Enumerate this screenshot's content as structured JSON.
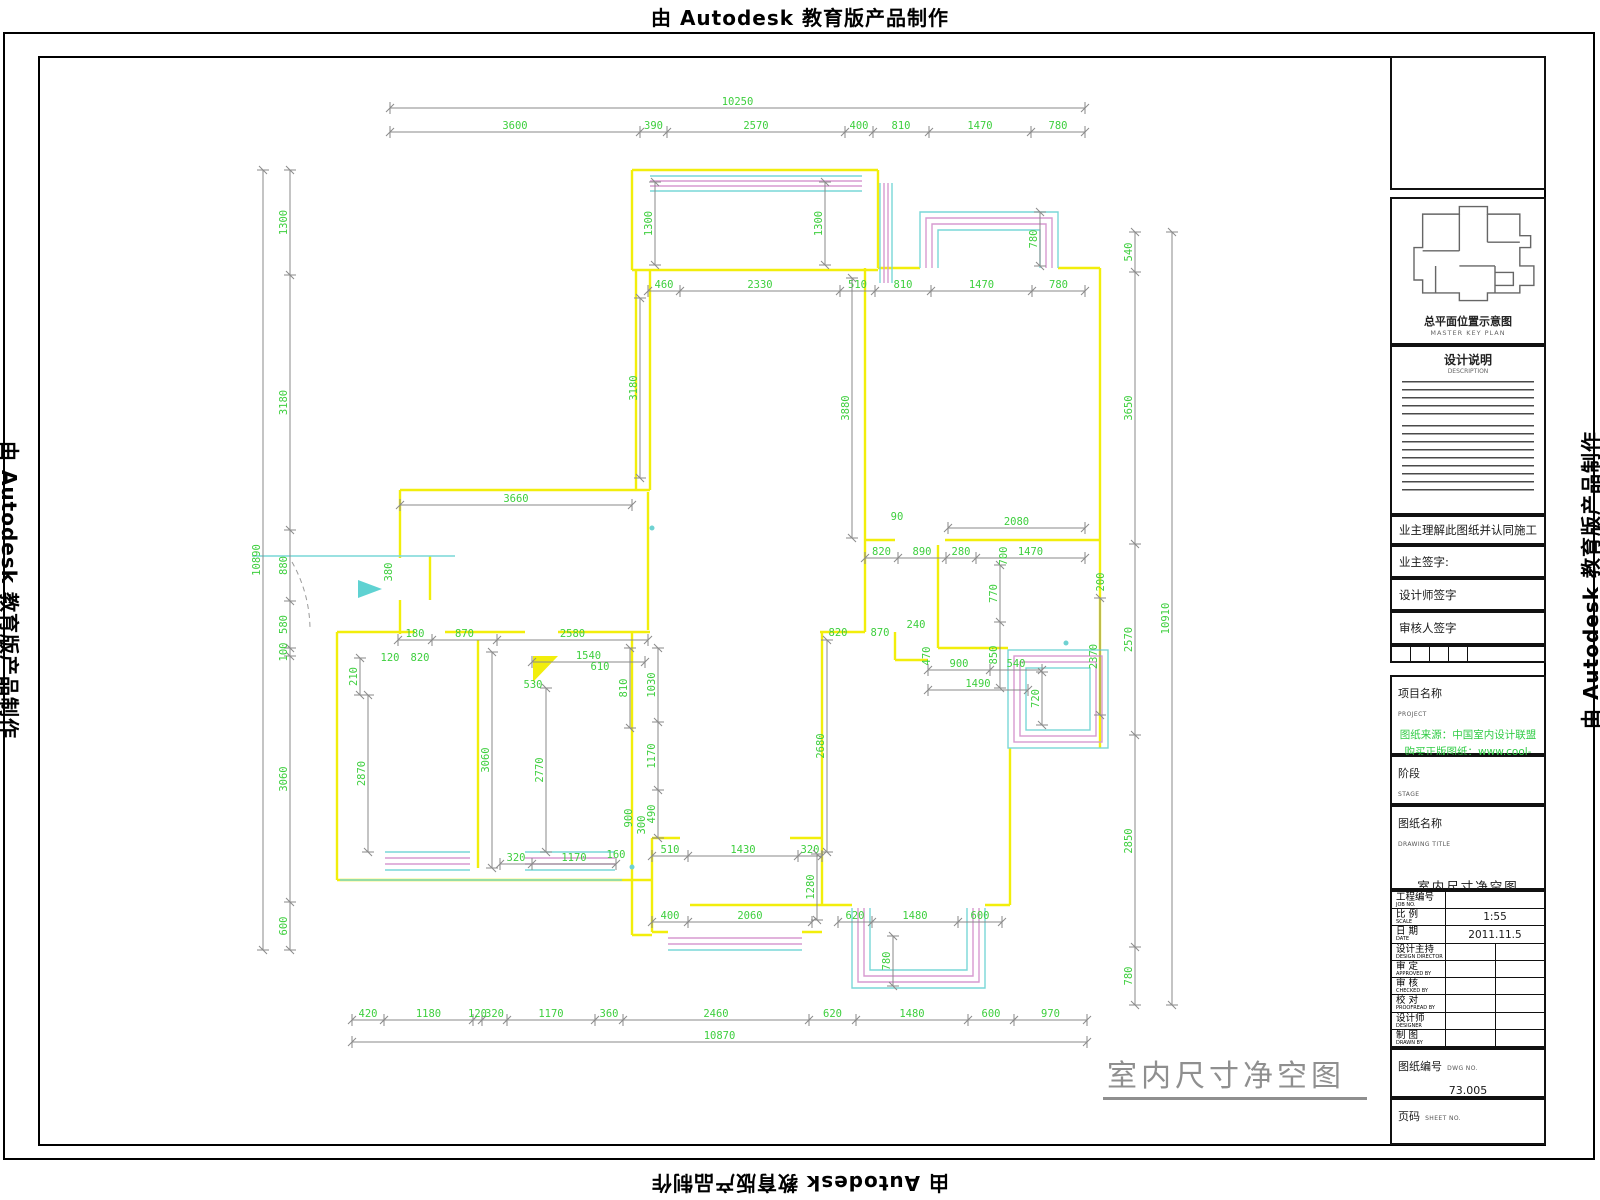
{
  "watermark": {
    "text": "由 Autodesk 教育版产品制作"
  },
  "drawing_caption": {
    "title": "室内尺寸净空图"
  },
  "title_block": {
    "key_plan_caption": "总平面位置示意图",
    "key_plan_caption_en": "MASTER KEY PLAN",
    "notes_title": "设计说明",
    "notes_title_en": "DESCRIPTION",
    "agreement": "业主理解此图纸并认同施工",
    "owner_sign": "业主签字:",
    "designer_sign": "设计师签字",
    "reviewer_sign": "审核人签字",
    "project_label": "项目名称",
    "project_label_en": "PROJECT",
    "source_line1": "图纸来源：中国室内设计联盟",
    "source_line2": "购买正版图纸：www.cool-de.com",
    "stage_label": "阶段",
    "stage_label_en": "STAGE",
    "dwg_title_label": "图纸名称",
    "dwg_title_label_en": "DRAWING TITLE",
    "dwg_title_value": "室内尺寸净空图",
    "rows": [
      {
        "label": "工程编号",
        "en": "JOB NO.",
        "value": ""
      },
      {
        "label": "比 例",
        "en": "SCALE",
        "value": "1:55"
      },
      {
        "label": "日 期",
        "en": "DATE",
        "value": "2011.11.5"
      },
      {
        "label": "设计主持",
        "en": "DESIGN DIRECTOR",
        "value": ""
      },
      {
        "label": "审 定",
        "en": "APPROVED BY",
        "value": ""
      },
      {
        "label": "审 核",
        "en": "CHECKED BY",
        "value": ""
      },
      {
        "label": "校 对",
        "en": "PROOFREAD BY",
        "value": ""
      },
      {
        "label": "设计师",
        "en": "DESIGNER",
        "value": ""
      },
      {
        "label": "制 图",
        "en": "DRAWN BY",
        "value": ""
      }
    ],
    "dwg_no_label": "图纸编号",
    "dwg_no_en": "DWG NO.",
    "dwg_no_value": "73.005",
    "sheet_label": "页码",
    "sheet_en": "SHEET NO.",
    "sheet_value": ""
  },
  "colors": {
    "wall": "#f2ee0b",
    "dim_line": "#8a8a8a",
    "dim_text": "#3ecf3e",
    "window_cyan": "#79d7d7",
    "window_magenta": "#d79ad0",
    "caption_gray": "#8f8f8f"
  },
  "plan": {
    "chains": [
      {
        "o": "h",
        "c": 108,
        "t": [
          390,
          1085
        ],
        "l": [
          "10250"
        ]
      },
      {
        "o": "h",
        "c": 132,
        "t": [
          390,
          640,
          667,
          845,
          873,
          929,
          1031,
          1085
        ],
        "l": [
          "3600",
          "390",
          "2570",
          "400",
          "810",
          "1470",
          "780"
        ]
      },
      {
        "o": "h",
        "c": 291,
        "t": [
          648,
          680,
          840,
          875,
          931,
          1032,
          1085
        ],
        "l": [
          "460",
          "2330",
          "510",
          "810",
          "1470",
          "780"
        ]
      },
      {
        "o": "h",
        "c": 505,
        "t": [
          400,
          632
        ],
        "l": [
          "3660"
        ]
      },
      {
        "o": "h",
        "c": 528,
        "t": [
          948,
          1085
        ],
        "l": [
          "2080"
        ]
      },
      {
        "o": "h",
        "c": 558,
        "t": [
          865,
          898,
          946,
          976,
          1085
        ],
        "l": [
          "820",
          "890",
          "280",
          "1470"
        ]
      },
      {
        "o": "h",
        "c": 670,
        "t": [
          928,
          990,
          1042
        ],
        "l": [
          "900",
          "540"
        ]
      },
      {
        "o": "h",
        "c": 690,
        "t": [
          928,
          1028
        ],
        "l": [
          "1490"
        ]
      },
      {
        "o": "h",
        "c": 640,
        "t": [
          398,
          432,
          497,
          648
        ],
        "l": [
          "180",
          "870",
          "2580"
        ]
      },
      {
        "o": "h",
        "c": 662,
        "t": [
          532,
          645
        ],
        "l": [
          "1540"
        ]
      },
      {
        "o": "h",
        "c": 856,
        "t": [
          652,
          688,
          798,
          822
        ],
        "l": [
          "510",
          "1430",
          "320"
        ]
      },
      {
        "o": "h",
        "c": 922,
        "t": [
          652,
          688,
          812
        ],
        "l": [
          "400",
          "2060"
        ]
      },
      {
        "o": "h",
        "c": 922,
        "t": [
          838,
          872,
          958,
          1002
        ],
        "l": [
          "620",
          "1480",
          "600"
        ]
      },
      {
        "o": "h",
        "c": 864,
        "t": [
          500,
          532,
          616
        ],
        "l": [
          "320",
          "1170"
        ]
      },
      {
        "o": "h",
        "c": 1020,
        "t": [
          352,
          384,
          473,
          482,
          507,
          595,
          623,
          809,
          856,
          968,
          1014,
          1087
        ],
        "l": [
          "420",
          "1180",
          "120",
          "320",
          "1170",
          "360",
          "2460",
          "620",
          "1480",
          "600",
          "970"
        ]
      },
      {
        "o": "h",
        "c": 1042,
        "t": [
          352,
          1087
        ],
        "l": [
          "10870"
        ]
      },
      {
        "o": "v",
        "c": 263,
        "t": [
          170,
          950
        ],
        "l": [
          "10890"
        ]
      },
      {
        "o": "v",
        "c": 290,
        "t": [
          170,
          275,
          530,
          601,
          648,
          656,
          902,
          950
        ],
        "l": [
          "1300",
          "3180",
          "880",
          "580",
          "100",
          "3060",
          "600"
        ]
      },
      {
        "o": "v",
        "c": 1135,
        "t": [
          232,
          272,
          544,
          735,
          947,
          1005
        ],
        "l": [
          "540",
          "3650",
          "2570",
          "2850",
          "780"
        ]
      },
      {
        "o": "v",
        "c": 1172,
        "t": [
          232,
          1005
        ],
        "l": [
          "10910"
        ]
      },
      {
        "o": "v",
        "c": 655,
        "t": [
          182,
          265
        ],
        "l": [
          "1300"
        ]
      },
      {
        "o": "v",
        "c": 825,
        "t": [
          182,
          265
        ],
        "l": [
          "1300"
        ]
      },
      {
        "o": "v",
        "c": 852,
        "t": [
          278,
          538
        ],
        "l": [
          "3880"
        ]
      },
      {
        "o": "v",
        "c": 640,
        "t": [
          298,
          478
        ],
        "l": [
          "3180"
        ]
      },
      {
        "o": "v",
        "c": 1040,
        "t": [
          212,
          266
        ],
        "l": [
          "780"
        ]
      },
      {
        "o": "v",
        "c": 1000,
        "t": [
          565,
          622,
          688
        ],
        "l": [
          "770",
          "850"
        ]
      },
      {
        "o": "v",
        "c": 1100,
        "t": [
          598,
          715
        ],
        "l": [
          "2370"
        ]
      },
      {
        "o": "v",
        "c": 1042,
        "t": [
          672,
          725
        ],
        "l": [
          "720"
        ]
      },
      {
        "o": "v",
        "c": 827,
        "t": [
          640,
          852
        ],
        "l": [
          "2680"
        ]
      },
      {
        "o": "v",
        "c": 817,
        "t": [
          854,
          920
        ],
        "l": [
          "1280"
        ]
      },
      {
        "o": "v",
        "c": 893,
        "t": [
          936,
          986
        ],
        "l": [
          "780"
        ]
      },
      {
        "o": "v",
        "c": 368,
        "t": [
          695,
          852
        ],
        "l": [
          "2870"
        ]
      },
      {
        "o": "v",
        "c": 492,
        "t": [
          652,
          868
        ],
        "l": [
          "3060"
        ]
      },
      {
        "o": "v",
        "c": 546,
        "t": [
          688,
          852
        ],
        "l": [
          "2770"
        ]
      },
      {
        "o": "v",
        "c": 360,
        "t": [
          658,
          695
        ],
        "l": [
          "210"
        ]
      },
      {
        "o": "v",
        "c": 630,
        "t": [
          648,
          728
        ],
        "l": [
          "810"
        ]
      },
      {
        "o": "v",
        "c": 658,
        "t": [
          648,
          722,
          790,
          838
        ],
        "l": [
          "1030",
          "1170",
          "490"
        ]
      }
    ],
    "labels": [
      {
        "t": "380",
        "x": 392,
        "y": 572,
        "v": 1
      },
      {
        "t": "90",
        "x": 897,
        "y": 520
      },
      {
        "t": "700",
        "x": 1007,
        "y": 556,
        "v": 1
      },
      {
        "t": "200",
        "x": 1104,
        "y": 582,
        "v": 1
      },
      {
        "t": "240",
        "x": 916,
        "y": 628
      },
      {
        "t": "870",
        "x": 880,
        "y": 636
      },
      {
        "t": "820",
        "x": 838,
        "y": 636
      },
      {
        "t": "470",
        "x": 930,
        "y": 656,
        "v": 1
      },
      {
        "t": "820",
        "x": 420,
        "y": 661
      },
      {
        "t": "120",
        "x": 390,
        "y": 661
      },
      {
        "t": "530",
        "x": 533,
        "y": 688
      },
      {
        "t": "610",
        "x": 600,
        "y": 670
      },
      {
        "t": "900",
        "x": 632,
        "y": 818,
        "v": 1
      },
      {
        "t": "300",
        "x": 645,
        "y": 825,
        "v": 1
      },
      {
        "t": "160",
        "x": 616,
        "y": 858
      }
    ]
  }
}
